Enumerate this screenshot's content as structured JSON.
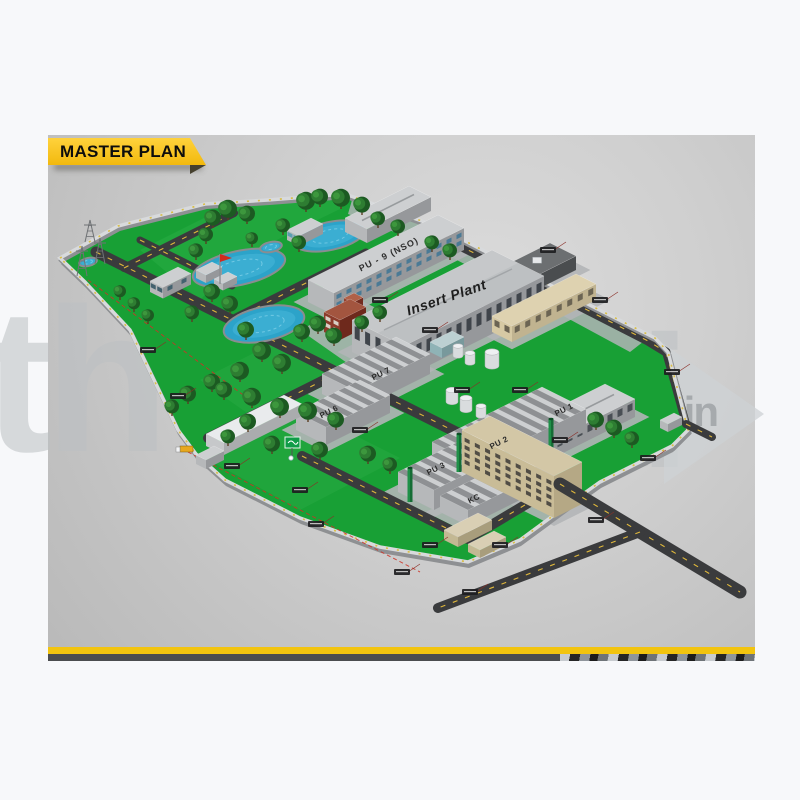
{
  "header": {
    "title": "MASTER PLAN"
  },
  "watermark": {
    "left": "th",
    "right": "ai",
    "badge": ".in"
  },
  "map": {
    "labels": {
      "insert_plant": "Insert Plant",
      "pu9": "PU - 9 (NSO)",
      "pu7": "PU 7",
      "pu6": "PU 6",
      "pu1": "PU 1",
      "pu2": "PU 2",
      "pu3": "PU 3",
      "kc": "KC"
    },
    "features": [
      "water-pond",
      "trees",
      "transmission-tower",
      "red-flag",
      "green-signboard",
      "boundary-wall",
      "factory-sheds",
      "chimney-stacks",
      "storage-tanks",
      "admin-block",
      "roads"
    ],
    "colors": {
      "grass": "#18a035",
      "water": "#2ca3c9",
      "road": "#3a3b3d",
      "wall": "#d8dadc",
      "accent_yellow": "#f2c40f",
      "chimney_green": "#1f9048"
    }
  },
  "footer": {
    "accent_yellow": "#f2c40f",
    "hazard_dark": "#4b4d4f"
  }
}
